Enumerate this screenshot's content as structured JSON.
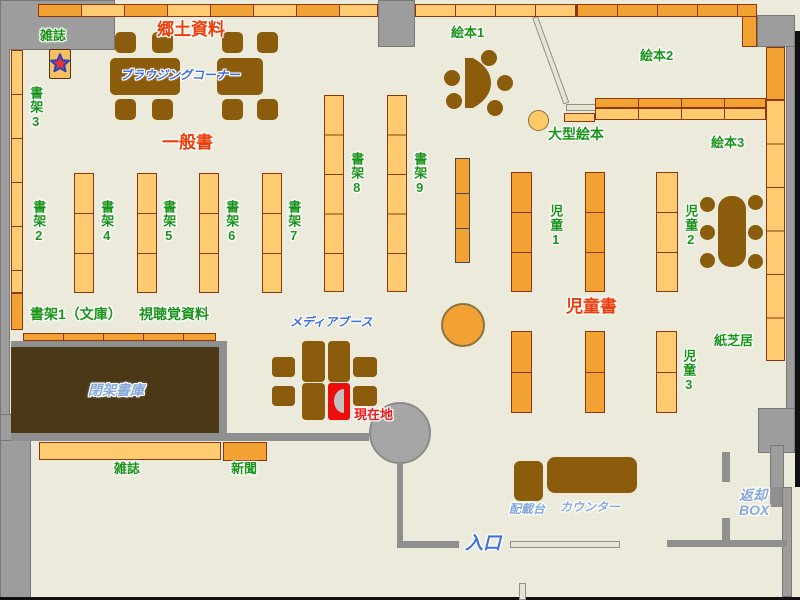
{
  "labels": {
    "magazine_top": "雑誌",
    "shelf3": "書架3",
    "local_materials": "郷土資料",
    "browsing_corner": "ブラウジングコーナー",
    "general_books": "一般書",
    "shelf2": "書架2",
    "shelf4": "書架4",
    "shelf5": "書架5",
    "shelf6": "書架6",
    "shelf7": "書架7",
    "shelf8": "書架8",
    "shelf9": "書架9",
    "shelf1_bunko": "書架1（文庫）",
    "audiovisual": "視聴覚資料",
    "picture_books1": "絵本1",
    "picture_books2": "絵本2",
    "picture_books3": "絵本3",
    "large_picture_books": "大型絵本",
    "children1": "児童1",
    "children2": "児童2",
    "children3": "児童3",
    "children_books": "児童書",
    "kamishibai": "紙芝居",
    "media_booth": "メディアブース",
    "current_location": "現在地",
    "closed_stacks": "閉架書庫",
    "magazine_bottom": "雑誌",
    "newspaper": "新聞",
    "entrance": "入口",
    "loading_stand": "配載台",
    "counter": "カウンター",
    "return_box_line1": "返却",
    "return_box_line2": "BOX"
  },
  "colors": {
    "floor": "#ECEBDB",
    "wall_gray": "#9D9D9D",
    "shelf_dark_orange": "#F2A233",
    "shelf_light_orange": "#FFCB70",
    "shelf_border": "#8C3812",
    "furniture_brown": "#8A5C0B",
    "closed_stacks_brown": "#4A3817",
    "label_green": "#1C941C",
    "label_red": "#EB3C0A",
    "label_blue": "#3E6EE0",
    "label_light_blue": "#87A9DC",
    "current_location_red": "#EE0D0D"
  }
}
